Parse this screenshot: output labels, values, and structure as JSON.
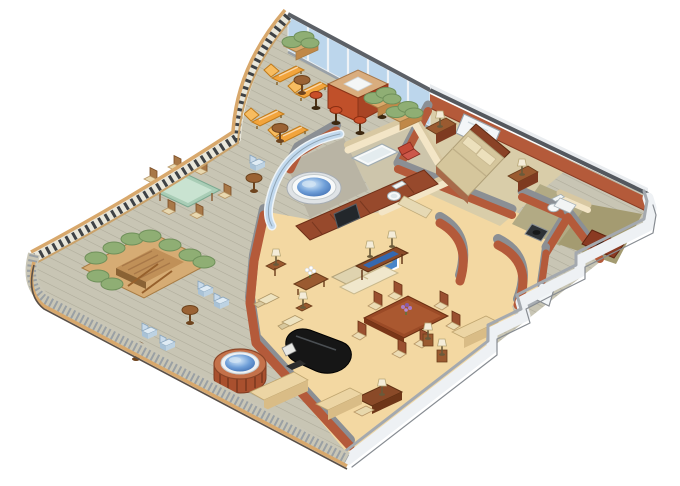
{
  "scene": {
    "type": "isometric-cutaway-floor-plan",
    "subject": "penthouse suite with wraparound teak deck",
    "background": "#ffffff",
    "visible_text": ""
  },
  "palette": {
    "deckBase": "#c8c5b4",
    "deckLine": "#aeab9a",
    "railWood": "#d8a86c",
    "balusterDark": "#3f4245",
    "railBand": "#e9e7db",
    "bulwarkBaluster": "#9aa0a4",
    "bulwarkDarkLine": "#5a5048",
    "glass": "#bcd6ec",
    "glassFrame": "#e8edf2",
    "glassCap": "#5c6066",
    "glassBase": "#98a0a8",
    "wallOuterWhite": "#eef1f4",
    "wallOuterCap": "#a4a9af",
    "wallTopWhite": "#e9ecef",
    "wallCapDark": "#54585e",
    "wallTerra": "#b45a3a",
    "wallTerraDark": "#8a3c24",
    "wallCapGray": "#8b8f94",
    "creamWall": "#f3e5c6",
    "creamCap": "#d8c8a2",
    "carpetLiving": "#f3d8a2",
    "carpetBedroom": "#d9cda9",
    "bathFloor": "#cdc5ab",
    "bath2Floor": "#b2aa84",
    "closetFloor": "#a49b71",
    "spaFloor": "#b9b4a4",
    "recessFloor": "#a8adb2",
    "cabinetWood": "#97492c",
    "cabinetPanel": "#7a3820",
    "woodDark": "#8a4a28",
    "woodMid": "#9a5a30",
    "woodEdge": "#6a3c1a",
    "sofaCream": "#f0e7cc",
    "sofaShade": "#dfd3af",
    "chairCream": "#eee3c0",
    "chairShade": "#d8c89e",
    "tableDining": "#9a4a26",
    "chairWoodInt": "#9a5030",
    "seatCream": "#ecdcb4",
    "pianoBlack": "#161616",
    "pianoHi": "#4a4e52",
    "bedSpread": "#d5c69c",
    "bedSide": "#a86a4a",
    "pillow": "#ece0bc",
    "headboard": "#8a4226",
    "mirror": "#f3f6f8",
    "fixtureWhite": "#f7f9f9",
    "fixtureStroke": "#a0acb2",
    "loungeOrange": "#f2a43c",
    "loungeBack": "#f7bc60",
    "loungeEdge": "#c07a1a",
    "barFront": "#c0502a",
    "barSide": "#a84424",
    "barTop": "#d9ad7e",
    "stoolRed": "#c94e28",
    "tableGlassGreen": "#a9cdb6",
    "tableGlassHi": "#cfe6d6",
    "hedge": "#8fae74",
    "hedgeEdge": "#6f905a",
    "planterWood": "#d9a96c",
    "planterFront": "#c08848",
    "blueChair": "#dfebf4",
    "blueChairDark": "#c8daea",
    "blueChairStroke": "#8aa6be",
    "tubSide": "#a9502e",
    "tubRib": "#7e3a20",
    "tubRim": "#c4714a",
    "tubWhite": "#eef1f3",
    "waterDeep": "#3f6db0",
    "waterMid": "#6f9fd8",
    "waterLight": "#dceefc",
    "tvBlue": "#4a86c8",
    "tvDark": "#23272b",
    "consoleBlue": "#3468b0",
    "flowerPurple": "#a97cc8",
    "flowerWhite": "#ffffff",
    "leafGreen": "#4a7c3a",
    "redChair": "#c44a38",
    "sunkenTop": "#d6ac74",
    "sunkenFloor": "#c09058",
    "sunkenSide": "#8a6234",
    "stepLine": "#a87848"
  },
  "rooms": [
    {
      "id": "deck",
      "name": "wraparound teak deck"
    },
    {
      "id": "living-room",
      "name": "living room"
    },
    {
      "id": "dining-area",
      "name": "dining area"
    },
    {
      "id": "bedroom",
      "name": "bedroom"
    },
    {
      "id": "master-bath",
      "name": "master bathroom"
    },
    {
      "id": "spa-alcove",
      "name": "indoor whirlpool alcove"
    },
    {
      "id": "guest-bath",
      "name": "guest bathroom"
    },
    {
      "id": "closet",
      "name": "walk-in closet"
    },
    {
      "id": "entry-hall",
      "name": "entry hall"
    }
  ],
  "objects": {
    "deck": {
      "sun_loungers": 4,
      "drink_tables": 6,
      "bar_counter": 1,
      "bar_stools": 4,
      "hedge_planters": 3,
      "glass_dining_table": 1,
      "deck_dining_chairs": 6,
      "sunken_stair_garden": 1,
      "blue_deck_chairs": 5,
      "outdoor_hot_tub": 1,
      "benches": 2
    },
    "living_room": {
      "sofa": 1,
      "console_table": 1,
      "armchairs": 2,
      "coffee_table": 1,
      "white_flower_vase": 1,
      "grand_piano": 1,
      "tv_cabinet_wall": 1,
      "wall_tv": 1,
      "table_lamps": 5
    },
    "dining_area": {
      "dining_table": 1,
      "dining_chairs": 7,
      "purple_flower_vase": 1,
      "writing_desk": 1,
      "desk_chair": 1,
      "pedestal_lamps": 2
    },
    "bedroom": {
      "double_bed": 1,
      "pillows": 2,
      "headboard_mirror": 1,
      "nightstands": 2,
      "bedside_lamps": 2,
      "red_armchair": 1,
      "foot_bench": 1
    },
    "master_bath": {
      "bathtub": 1,
      "toilet": 1
    },
    "spa_alcove": {
      "whirlpool_tub": 1,
      "glass_enclosure": 1
    },
    "guest_bath": {
      "toilet": 1,
      "dark_shower": 1,
      "vanity": 1
    },
    "closet": {
      "bench_shelf": 1
    },
    "entry_hall": {
      "door": 1,
      "curved_walls": 2
    }
  }
}
